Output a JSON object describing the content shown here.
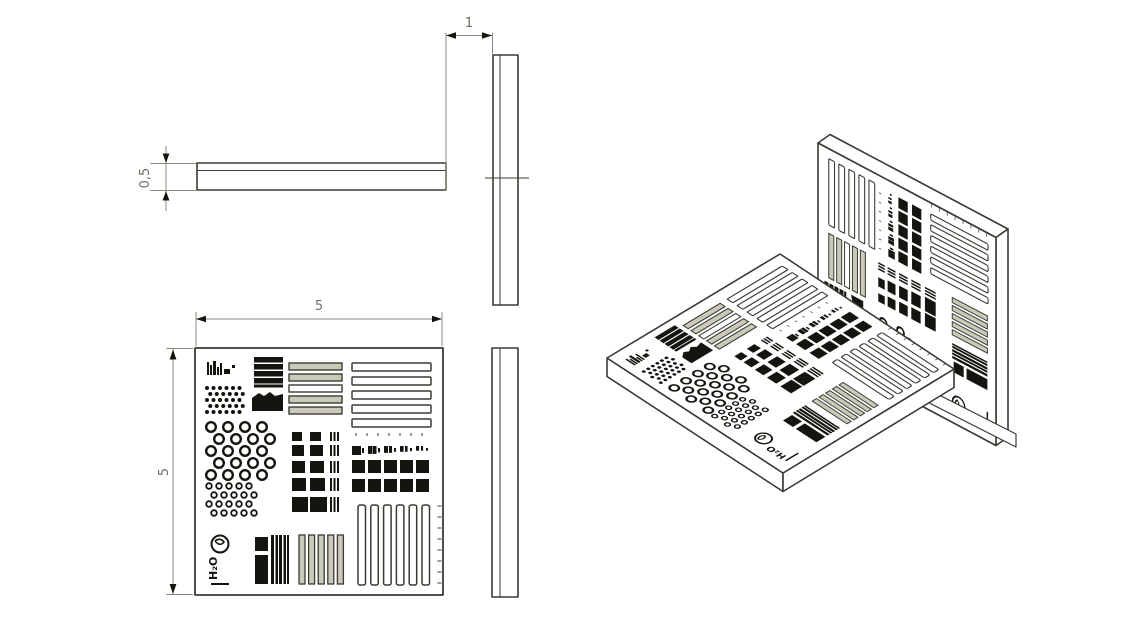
{
  "drawing": {
    "dimensions": {
      "plate_thickness": "0,5",
      "gap_width": "1",
      "plate_width": "5",
      "plate_height": "5"
    },
    "logo_text": "H₂O"
  },
  "colors": {
    "background": "#ffffff",
    "outline": "#3b3b33",
    "dimension_line": "#8b8b7b",
    "dimension_text": "#6f6f61",
    "pattern_black": "#15150f",
    "bar_fill": "#cac9ba",
    "face_white": "#ffffff"
  }
}
